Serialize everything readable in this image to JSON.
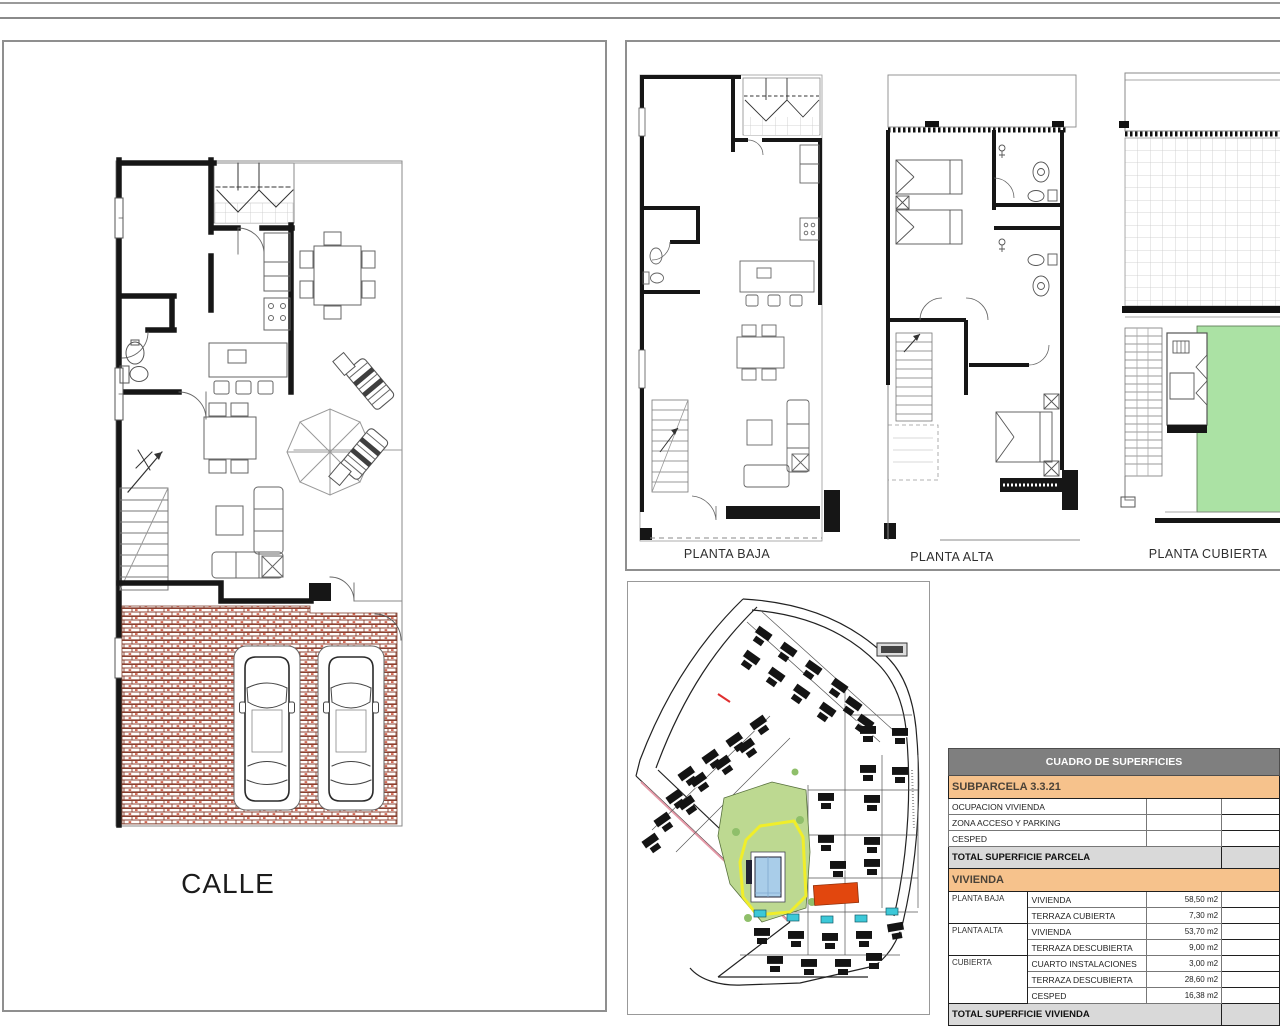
{
  "sheet": {
    "street_label": "CALLE",
    "floor_plans": [
      {
        "label": "PLANTA BAJA"
      },
      {
        "label": "PLANTA ALTA"
      },
      {
        "label": "PLANTA CUBIERTA"
      }
    ]
  },
  "table": {
    "title": "CUADRO DE SUPERFICIES",
    "subparcela_title": "SUBPARCELA 3.3.21",
    "parcela_rows": [
      {
        "label": "OCUPACION VIVIENDA",
        "value": ""
      },
      {
        "label": "ZONA ACCESO Y PARKING",
        "value": ""
      },
      {
        "label": "CESPED",
        "value": ""
      }
    ],
    "total_parcela_label": "TOTAL SUPERFICIE PARCELA",
    "vivienda_title": "VIVIENDA",
    "vivienda_rows": [
      {
        "group": "PLANTA BAJA",
        "concept": "VIVIENDA",
        "value": "58,50 m2"
      },
      {
        "group": "",
        "concept": "TERRAZA CUBIERTA",
        "value": "7,30 m2"
      },
      {
        "group": "PLANTA ALTA",
        "concept": "VIVIENDA",
        "value": "53,70 m2"
      },
      {
        "group": "",
        "concept": "TERRAZA DESCUBIERTA",
        "value": "9,00 m2"
      },
      {
        "group": "CUBIERTA",
        "concept": "CUARTO INSTALACIONES",
        "value": "3,00 m2"
      },
      {
        "group": "",
        "concept": "TERRAZA DESCUBIERTA",
        "value": "28,60 m2"
      },
      {
        "group": "",
        "concept": "CESPED",
        "value": "16,38 m2"
      }
    ],
    "total_vivienda_label": "TOTAL SUPERFICIE VIVIENDA"
  },
  "colors": {
    "table_header_bg": "#7f7f7f",
    "section_orange": "#f6c28c",
    "total_gray": "#d9d9d9",
    "highlight_plot_orange": "#e2470e",
    "pool_blue": "#a9cde9",
    "small_pool_cyan": "#3cc8d8",
    "lawn_green": "#abe2a4",
    "siteplan_green": "#bdd991",
    "pool_zone_yellow": "#f0ee2a",
    "brick_mortar": "#8a4030"
  }
}
